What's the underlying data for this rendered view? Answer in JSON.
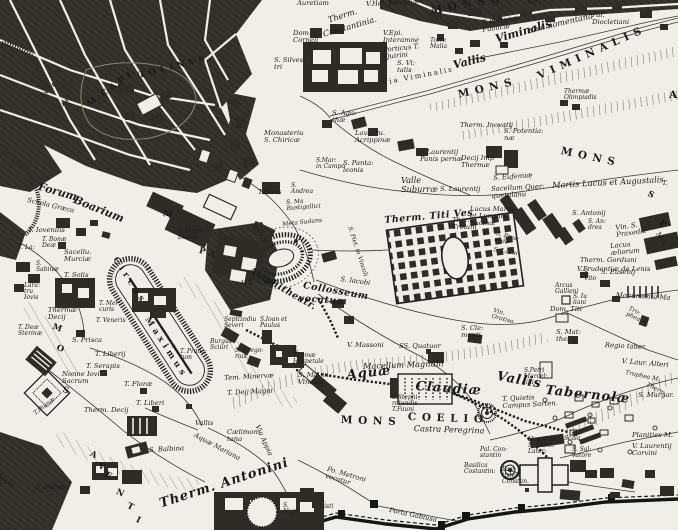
{
  "map": {
    "palette": {
      "paper": "#f0eee6",
      "ink": "#1d1b15",
      "city_block": "#32302a",
      "hill_hatch": "#76725f"
    },
    "labels": [
      {
        "t": "Auretiam",
        "x": 297,
        "y": 0,
        "r": 0,
        "c": "s"
      },
      {
        "t": "V.Hel. Ferrariæ",
        "x": 366,
        "y": 1,
        "r": -2,
        "c": "s"
      },
      {
        "t": "Therm.",
        "x": 327,
        "y": 16,
        "r": -18,
        "c": "m"
      },
      {
        "t": "Constantinia.",
        "x": 322,
        "y": 30,
        "r": -16,
        "c": "m"
      },
      {
        "t": "Dom.\nCorneli",
        "x": 293,
        "y": 30,
        "r": 0,
        "c": "s"
      },
      {
        "t": "S. Silves:\ntri",
        "x": 274,
        "y": 57,
        "r": 0,
        "c": "s"
      },
      {
        "t": "V.Epi.\nInteramne",
        "x": 383,
        "y": 30,
        "r": 0,
        "c": "s"
      },
      {
        "t": "Torre\nMalia",
        "x": 430,
        "y": 38,
        "r": 0,
        "c": "t"
      },
      {
        "t": "Porticus T.\nQuirini",
        "x": 383,
        "y": 47,
        "r": -6,
        "c": "s"
      },
      {
        "t": "S. Vi:\ntalis",
        "x": 397,
        "y": 60,
        "r": 0,
        "c": "s"
      },
      {
        "t": "M O N S   Q U I R",
        "x": 430,
        "y": 6,
        "r": -10,
        "c": "caps"
      },
      {
        "t": "ubi Faribus",
        "x": 527,
        "y": 0,
        "r": -12,
        "c": "t"
      },
      {
        "t": "T. Fortunæ\nPublicæ",
        "x": 481,
        "y": 20,
        "r": -8,
        "c": "s"
      },
      {
        "t": "sive nomentana",
        "x": 528,
        "y": 26,
        "r": -13,
        "c": "m"
      },
      {
        "t": "Pal.\nDiocletiani",
        "x": 592,
        "y": 12,
        "r": 0,
        "c": "s"
      },
      {
        "t": "Vallis",
        "x": 452,
        "y": 60,
        "r": -14,
        "c": "lg"
      },
      {
        "t": "Viminalis",
        "x": 494,
        "y": 34,
        "r": -16,
        "c": "lg"
      },
      {
        "t": "M O N S",
        "x": 457,
        "y": 90,
        "r": -13,
        "c": "caps"
      },
      {
        "t": "V I M I N A L I S",
        "x": 536,
        "y": 72,
        "r": -24,
        "c": "caps"
      },
      {
        "t": "Thermæ\nOlimpiadis",
        "x": 564,
        "y": 89,
        "r": 0,
        "c": "t"
      },
      {
        "t": "M O N S",
        "x": 562,
        "y": 146,
        "r": 12,
        "c": "caps"
      },
      {
        "t": "A",
        "x": 669,
        "y": 90,
        "r": 0,
        "c": "caps"
      },
      {
        "t": "Via Viminalis",
        "x": 382,
        "y": 80,
        "r": -11,
        "c": "capsR"
      },
      {
        "t": "Therm. Inovatij",
        "x": 460,
        "y": 122,
        "r": 0,
        "c": "s"
      },
      {
        "t": "S. Potentia:\nnæ",
        "x": 504,
        "y": 128,
        "r": 0,
        "c": "s"
      },
      {
        "t": "Decij Imp\nThermæ",
        "x": 461,
        "y": 155,
        "r": 0,
        "c": "s"
      },
      {
        "t": "S.Laurentij\nPanis pernæ",
        "x": 420,
        "y": 149,
        "r": 0,
        "c": "s"
      },
      {
        "t": "S. Aga:\nthæ",
        "x": 332,
        "y": 110,
        "r": 0,
        "c": "s"
      },
      {
        "t": "Lavacru.\nAcrippinæ",
        "x": 355,
        "y": 130,
        "r": 0,
        "c": "s"
      },
      {
        "t": "Monasteriu\nS. Chiricæ",
        "x": 264,
        "y": 130,
        "r": 0,
        "c": "s"
      },
      {
        "t": "S.Mar:\nin Campo",
        "x": 316,
        "y": 158,
        "r": 0,
        "c": "t"
      },
      {
        "t": "S. Panta:\nleonis",
        "x": 343,
        "y": 160,
        "r": 0,
        "c": "s"
      },
      {
        "t": "Valle\nSuburræ",
        "x": 401,
        "y": 176,
        "r": 0,
        "c": "m"
      },
      {
        "t": "S. Laurentij",
        "x": 440,
        "y": 186,
        "r": 0,
        "c": "s"
      },
      {
        "t": "S. Eufemiæ",
        "x": 493,
        "y": 175,
        "r": -4,
        "c": "s"
      },
      {
        "t": "Sacellum Quer:\nquetulanu",
        "x": 491,
        "y": 186,
        "r": -3,
        "c": "s"
      },
      {
        "t": "Lucus Martis\net Lunonis\nLucinæ",
        "x": 470,
        "y": 206,
        "r": 0,
        "c": "s"
      },
      {
        "t": "Martis Lucus et Augustalis",
        "x": 552,
        "y": 181,
        "r": -3,
        "c": "m"
      },
      {
        "t": "Ther.\nTroiani",
        "x": 452,
        "y": 217,
        "r": 0,
        "c": "s"
      },
      {
        "t": "S. Antonij",
        "x": 572,
        "y": 210,
        "r": 0,
        "c": "s"
      },
      {
        "t": "S. An:\ndrea",
        "x": 588,
        "y": 219,
        "r": 0,
        "c": "t"
      },
      {
        "t": "Vin. S.\nPraxedæ",
        "x": 615,
        "y": 225,
        "r": -8,
        "c": "s"
      },
      {
        "t": "S. Pras:\nsede",
        "x": 497,
        "y": 231,
        "r": 15,
        "c": "t"
      },
      {
        "t": "S. Lucia",
        "x": 494,
        "y": 247,
        "r": 10,
        "c": "t"
      },
      {
        "t": "Lacus\næliorum",
        "x": 610,
        "y": 243,
        "r": -5,
        "c": "s"
      },
      {
        "t": "Therm. Gordiani",
        "x": 580,
        "y": 257,
        "r": 0,
        "c": "s"
      },
      {
        "t": "V.Prudentiæ de Lenis",
        "x": 577,
        "y": 266,
        "r": 0,
        "c": "s"
      },
      {
        "t": "S.\nVito",
        "x": 584,
        "y": 270,
        "r": 0,
        "c": "t"
      },
      {
        "t": "S. Eusebij",
        "x": 601,
        "y": 269,
        "r": 0,
        "c": "s"
      },
      {
        "t": "Monumenta Ma",
        "x": 616,
        "y": 292,
        "r": 3,
        "c": "s"
      },
      {
        "t": "Arcus\nGallieni",
        "x": 555,
        "y": 283,
        "r": 0,
        "c": "t"
      },
      {
        "t": "S. Iu\nliani",
        "x": 573,
        "y": 294,
        "r": 0,
        "c": "t"
      },
      {
        "t": "Dom. Titi",
        "x": 550,
        "y": 306,
        "r": 0,
        "c": "s"
      },
      {
        "t": "S. Mat:\nthei",
        "x": 556,
        "y": 329,
        "r": 0,
        "c": "s"
      },
      {
        "t": "Tro:\nphea M.",
        "x": 630,
        "y": 306,
        "r": 25,
        "c": "t"
      },
      {
        "t": "Regio taber.",
        "x": 605,
        "y": 342,
        "r": 3,
        "c": "s"
      },
      {
        "t": "V. Laur. Alteri",
        "x": 622,
        "y": 358,
        "r": 5,
        "c": "s"
      },
      {
        "t": "Trophea M.",
        "x": 626,
        "y": 370,
        "r": 12,
        "c": "t"
      },
      {
        "t": "Therm.",
        "x": 648,
        "y": 382,
        "r": 28,
        "c": "t"
      },
      {
        "t": "S. Margar.",
        "x": 638,
        "y": 392,
        "r": 0,
        "c": "s"
      },
      {
        "t": "Planities M.",
        "x": 632,
        "y": 432,
        "r": 0,
        "c": "s"
      },
      {
        "t": "V. Laurentij\nCorvini",
        "x": 632,
        "y": 443,
        "r": 0,
        "c": "s"
      },
      {
        "t": "Vallis",
        "x": 498,
        "y": 370,
        "r": 10,
        "c": "xl"
      },
      {
        "t": "Tabernolæ",
        "x": 546,
        "y": 384,
        "r": 6,
        "c": "xl"
      },
      {
        "t": "S.Petri\nMarcel:\nlini",
        "x": 524,
        "y": 368,
        "r": 0,
        "c": "t"
      },
      {
        "t": "T. Quietis\nCampus Sarten.",
        "x": 502,
        "y": 396,
        "r": -3,
        "c": "s"
      },
      {
        "t": "Aquæ",
        "x": 346,
        "y": 369,
        "r": -6,
        "c": "xl"
      },
      {
        "t": "Claudiæ",
        "x": 416,
        "y": 380,
        "r": 4,
        "c": "xl"
      },
      {
        "t": "Macellum  Magnum",
        "x": 363,
        "y": 362,
        "r": -2,
        "c": "m"
      },
      {
        "t": "S.Stephi\nrotundis\nT.Fauni",
        "x": 392,
        "y": 395,
        "r": 0,
        "c": "t"
      },
      {
        "t": "M O N S",
        "x": 341,
        "y": 415,
        "r": 2,
        "c": "caps"
      },
      {
        "t": "C O E L I O",
        "x": 408,
        "y": 412,
        "r": 2,
        "c": "caps"
      },
      {
        "t": "Castra  Peregrina",
        "x": 414,
        "y": 424,
        "r": 2,
        "c": "m"
      },
      {
        "t": "V. Massoni",
        "x": 347,
        "y": 342,
        "r": 0,
        "c": "s"
      },
      {
        "t": "SS. Quatuor",
        "x": 399,
        "y": 343,
        "r": 0,
        "c": "s"
      },
      {
        "t": "S. Cle:\nmenti",
        "x": 461,
        "y": 325,
        "r": 0,
        "c": "s"
      },
      {
        "t": "Vin.\nOratiso",
        "x": 494,
        "y": 308,
        "r": 15,
        "c": "t"
      },
      {
        "t": "S. Iacobi",
        "x": 341,
        "y": 276,
        "r": 8,
        "c": "s"
      },
      {
        "t": "Meta  Sudans",
        "x": 282,
        "y": 222,
        "r": -6,
        "c": "t"
      },
      {
        "t": "S. Ma\nBustigallici",
        "x": 286,
        "y": 200,
        "r": -4,
        "c": "t"
      },
      {
        "t": "S.\nAndrea",
        "x": 291,
        "y": 183,
        "r": 0,
        "c": "t"
      },
      {
        "t": "T.Pacis",
        "x": 258,
        "y": 189,
        "r": 0,
        "c": "s"
      },
      {
        "t": "Amphitheatr.",
        "x": 252,
        "y": 266,
        "r": 30,
        "c": "lg2"
      },
      {
        "t": "Collosseum",
        "x": 304,
        "y": 281,
        "r": 10,
        "c": "lg2"
      },
      {
        "t": "vocatum",
        "x": 299,
        "y": 294,
        "r": 4,
        "c": "lg2"
      },
      {
        "t": "Therm. Titi Ves",
        "x": 384,
        "y": 216,
        "r": -5,
        "c": "lg2"
      },
      {
        "t": "S. Piet. in Vincoli",
        "x": 352,
        "y": 226,
        "r": 72,
        "c": "t"
      },
      {
        "t": "M.  C A P I",
        "x": 86,
        "y": 102,
        "r": -36,
        "c": "capsS"
      },
      {
        "t": "T O L I N V S",
        "x": 138,
        "y": 72,
        "r": -14,
        "c": "capsS"
      },
      {
        "t": "Forum",
        "x": 40,
        "y": 181,
        "r": 16,
        "c": "lg"
      },
      {
        "t": "Boarium",
        "x": 76,
        "y": 194,
        "r": 22,
        "c": "lg"
      },
      {
        "t": "Schola Græca",
        "x": 28,
        "y": 197,
        "r": 13,
        "c": "s"
      },
      {
        "t": "C i r c u s",
        "x": 118,
        "y": 256,
        "r": 57,
        "c": "capsS"
      },
      {
        "t": "M a x i m u s",
        "x": 150,
        "y": 316,
        "r": 57,
        "c": "capsS"
      },
      {
        "t": "T. Iovenilis",
        "x": 28,
        "y": 227,
        "r": 0,
        "c": "s"
      },
      {
        "t": "T. Bonæ\nDeæ",
        "x": 42,
        "y": 237,
        "r": 0,
        "c": "t"
      },
      {
        "t": "T. La:",
        "x": 18,
        "y": 245,
        "r": 0,
        "c": "t"
      },
      {
        "t": "Sacellu.\nMurciæ",
        "x": 64,
        "y": 249,
        "r": 0,
        "c": "s"
      },
      {
        "t": "T. Solis",
        "x": 64,
        "y": 272,
        "r": 0,
        "c": "s"
      },
      {
        "t": "S.\nSabinæ",
        "x": 36,
        "y": 261,
        "r": 0,
        "c": "t"
      },
      {
        "t": "Lara:\ntru\nIovis",
        "x": 24,
        "y": 283,
        "r": 0,
        "c": "t"
      },
      {
        "t": "Thermæ\nDecij",
        "x": 48,
        "y": 307,
        "r": 0,
        "c": "s"
      },
      {
        "t": "T. Mer:\ncuris",
        "x": 99,
        "y": 301,
        "r": 0,
        "c": "t"
      },
      {
        "t": "T. Veneris",
        "x": 96,
        "y": 318,
        "r": 0,
        "c": "t"
      },
      {
        "t": "T. Deæ\nSterinæ",
        "x": 18,
        "y": 325,
        "r": 0,
        "c": "t"
      },
      {
        "t": "S. Prisca",
        "x": 72,
        "y": 337,
        "r": 0,
        "c": "s"
      },
      {
        "t": "T. Liberij",
        "x": 95,
        "y": 351,
        "r": 0,
        "c": "s"
      },
      {
        "t": "T. Serapis",
        "x": 86,
        "y": 363,
        "r": 0,
        "c": "s"
      },
      {
        "t": "Nonne Iovi\nSacrum",
        "x": 62,
        "y": 371,
        "r": 0,
        "c": "s"
      },
      {
        "t": "T. Floræ",
        "x": 124,
        "y": 381,
        "r": 0,
        "c": "s"
      },
      {
        "t": "T. Liberi",
        "x": 136,
        "y": 400,
        "r": 0,
        "c": "s"
      },
      {
        "t": "Therm. Decij",
        "x": 84,
        "y": 407,
        "r": 0,
        "c": "s"
      },
      {
        "t": "T.Dianæ",
        "x": 33,
        "y": 412,
        "r": -38,
        "c": "t"
      },
      {
        "t": "S. Balbina",
        "x": 149,
        "y": 447,
        "r": -3,
        "c": "s"
      },
      {
        "t": "S. Sabas",
        "x": 36,
        "y": 484,
        "r": 0,
        "c": "s"
      },
      {
        "t": "Appia",
        "x": 0,
        "y": 472,
        "r": 38,
        "c": "s"
      },
      {
        "t": "Vallis",
        "x": 195,
        "y": 420,
        "r": 0,
        "c": "s"
      },
      {
        "t": "Aquæ Mariana",
        "x": 196,
        "y": 432,
        "r": 28,
        "c": "s"
      },
      {
        "t": "Cælimon:\ntana",
        "x": 227,
        "y": 429,
        "r": 0,
        "c": "s"
      },
      {
        "t": "Via Appia",
        "x": 260,
        "y": 424,
        "r": 66,
        "c": "s"
      },
      {
        "t": "Therm. Antonini",
        "x": 158,
        "y": 498,
        "r": -18,
        "c": "xl"
      },
      {
        "t": "Po. Metroni\nvocatur",
        "x": 328,
        "y": 466,
        "r": 16,
        "c": "s"
      },
      {
        "t": "Porta Gabiusa",
        "x": 390,
        "y": 507,
        "r": 12,
        "c": "s"
      },
      {
        "t": "S.\nSisti",
        "x": 320,
        "y": 498,
        "r": 0,
        "c": "t"
      },
      {
        "t": "S.\nNigri",
        "x": 283,
        "y": 503,
        "r": 0,
        "c": "t"
      },
      {
        "t": "Hospitale\nS. Ioann:\nLater:",
        "x": 528,
        "y": 437,
        "r": 0,
        "c": "t"
      },
      {
        "t": "Scala",
        "x": 564,
        "y": 436,
        "r": 0,
        "c": "t"
      },
      {
        "t": "S. Sal:\nvatore",
        "x": 572,
        "y": 447,
        "r": 0,
        "c": "t"
      },
      {
        "t": "Pal. Con:\nstantin",
        "x": 480,
        "y": 447,
        "r": 0,
        "c": "t"
      },
      {
        "t": "Basilica\nCostantin:",
        "x": 464,
        "y": 463,
        "r": 0,
        "c": "t"
      },
      {
        "t": "Bap:\ntisteri\nConstan.",
        "x": 502,
        "y": 467,
        "r": 0,
        "c": "t"
      },
      {
        "t": "M",
        "x": 164,
        "y": 210,
        "r": 15,
        "c": "capsS"
      },
      {
        "t": "P  A",
        "x": 200,
        "y": 247,
        "r": 15,
        "c": "capsS"
      },
      {
        "t": "T. Matri\nDeoru.",
        "x": 178,
        "y": 229,
        "r": 0,
        "c": "t"
      },
      {
        "t": "Septizodiu\nSeveri",
        "x": 224,
        "y": 317,
        "r": 0,
        "c": "t"
      },
      {
        "t": "S.Ioan et\nPaulus",
        "x": 260,
        "y": 317,
        "r": 0,
        "c": "t"
      },
      {
        "t": "Burgus\nSciuri",
        "x": 210,
        "y": 339,
        "r": 0,
        "c": "t"
      },
      {
        "t": "T. Prana:\ntum",
        "x": 180,
        "y": 349,
        "r": 0,
        "c": "t"
      },
      {
        "t": "S. Grego:\nrius",
        "x": 235,
        "y": 348,
        "r": 0,
        "c": "t"
      },
      {
        "t": "S.\nThomæ\nHospetale",
        "x": 293,
        "y": 347,
        "r": 0,
        "c": "t"
      },
      {
        "t": "Tem. Minervæ",
        "x": 224,
        "y": 375,
        "r": -3,
        "c": "s"
      },
      {
        "t": "T. Deij Magni",
        "x": 227,
        "y": 390,
        "r": -3,
        "c": "s"
      },
      {
        "t": "S. Ma- in\nVincola",
        "x": 298,
        "y": 372,
        "r": 0,
        "c": "s"
      },
      {
        "t": "V. S",
        "x": 241,
        "y": 281,
        "r": 0,
        "c": "t"
      },
      {
        "t": "M",
        "x": 54,
        "y": 323,
        "r": 20,
        "c": "capsS"
      },
      {
        "t": "O",
        "x": 58,
        "y": 344,
        "r": 20,
        "c": "capsS"
      },
      {
        "t": "S",
        "x": 64,
        "y": 386,
        "r": 20,
        "c": "capsS"
      },
      {
        "t": "A",
        "x": 92,
        "y": 450,
        "r": 25,
        "c": "capsS"
      },
      {
        "t": "V",
        "x": 100,
        "y": 462,
        "r": 25,
        "c": "capsS"
      },
      {
        "t": "E",
        "x": 107,
        "y": 471,
        "r": 25,
        "c": "capsS"
      },
      {
        "t": "N",
        "x": 118,
        "y": 488,
        "r": 25,
        "c": "capsS"
      },
      {
        "t": "T",
        "x": 129,
        "y": 502,
        "r": 25,
        "c": "capsS"
      },
      {
        "t": "I",
        "x": 138,
        "y": 516,
        "r": 25,
        "c": "capsS"
      },
      {
        "t": "T.",
        "x": 662,
        "y": 180,
        "r": 0,
        "c": "s"
      },
      {
        "t": "S",
        "x": 650,
        "y": 190,
        "r": 30,
        "c": "capsS"
      },
      {
        "t": "P",
        "x": 662,
        "y": 219,
        "r": 30,
        "c": "capsS"
      },
      {
        "t": "Mac",
        "x": 660,
        "y": 231,
        "r": 55,
        "c": "s"
      }
    ]
  }
}
